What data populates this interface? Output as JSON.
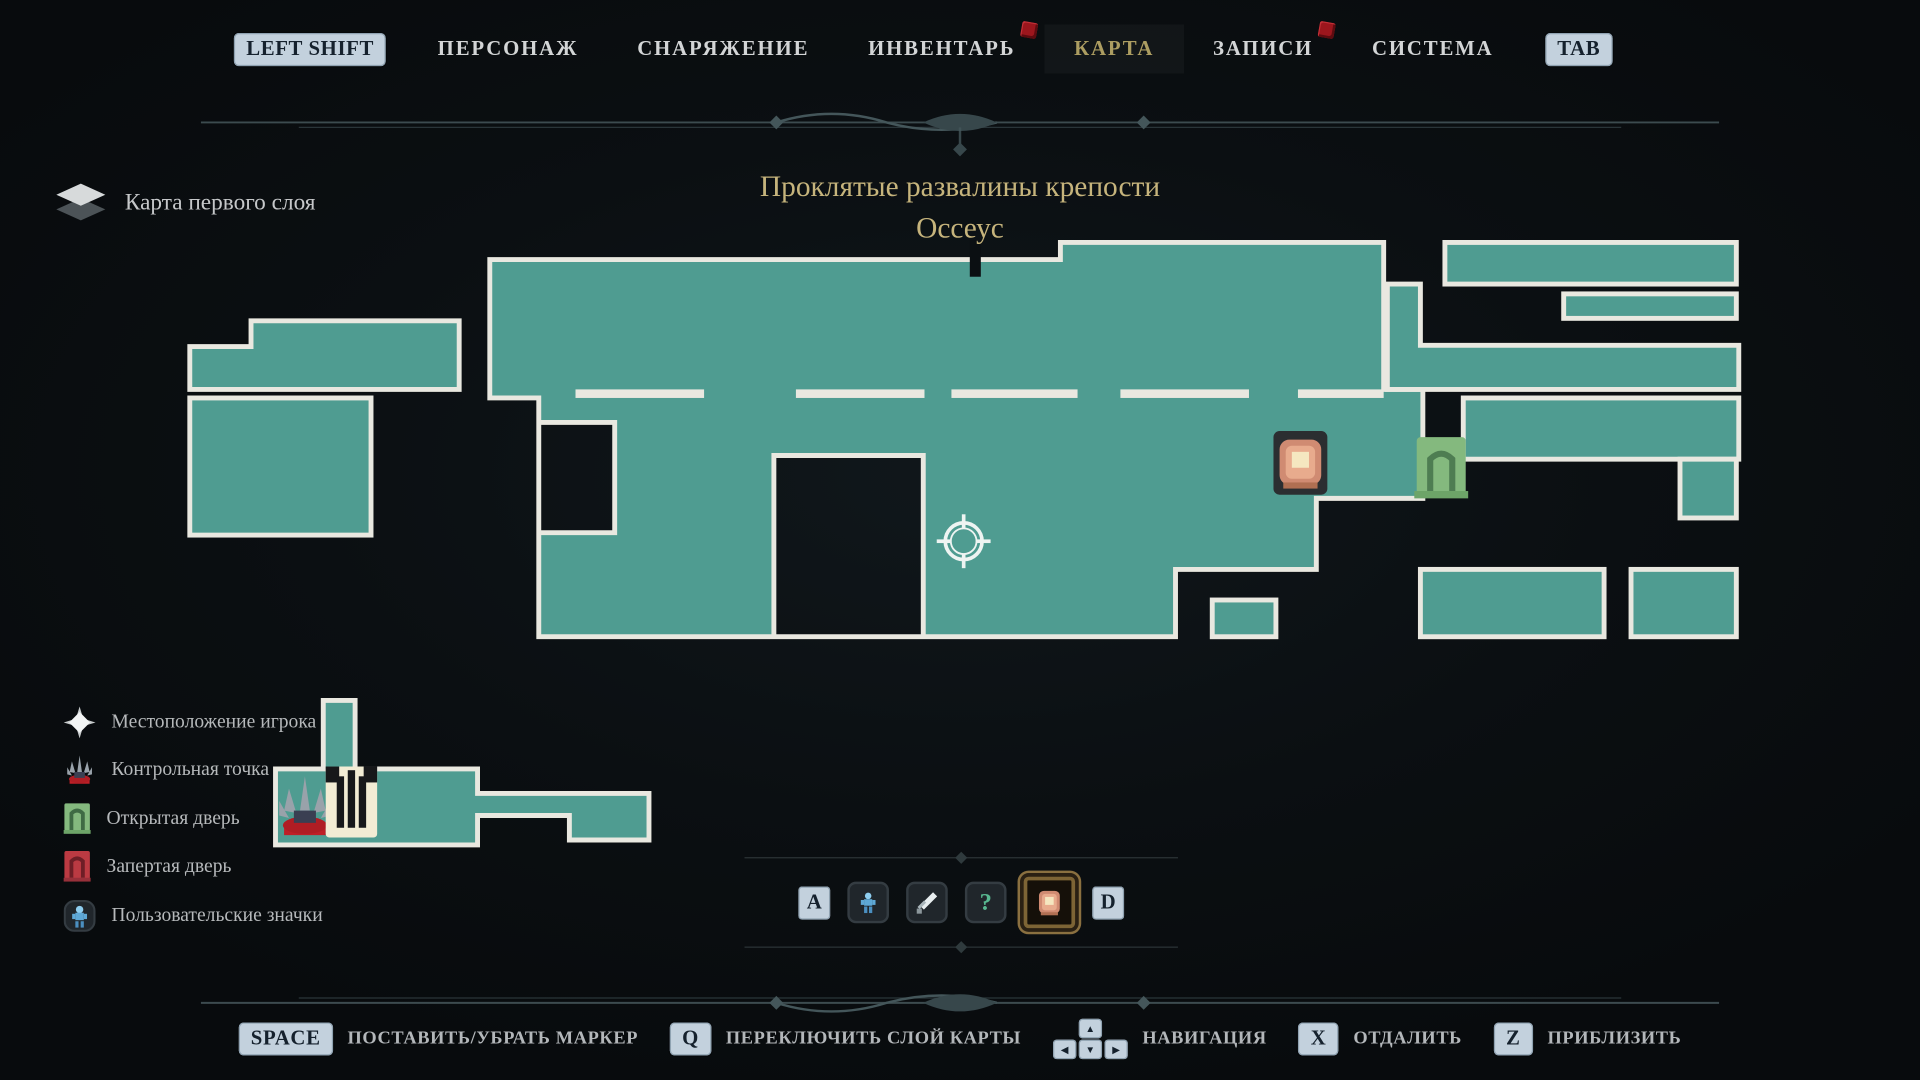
{
  "nav": {
    "left_key": "LEFT SHIFT",
    "right_key": "TAB",
    "tabs": [
      {
        "label": "ПЕРСОНАЖ"
      },
      {
        "label": "СНАРЯЖЕНИЕ"
      },
      {
        "label": "ИНВЕНТАРЬ",
        "badge": "new"
      },
      {
        "label": "КАРТА",
        "active": true
      },
      {
        "label": "ЗАПИСИ",
        "badge": "new"
      },
      {
        "label": "СИСТЕМА"
      }
    ]
  },
  "map_header": {
    "layer_label": "Карта первого слоя",
    "title_line1": "Проклятые развалины крепости",
    "title_line2": "Оссеус"
  },
  "legend": {
    "items": [
      {
        "icon": "player-location-icon",
        "label": "Местоположение игрока"
      },
      {
        "icon": "checkpoint-icon",
        "label": "Контрольная точка"
      },
      {
        "icon": "open-door-icon",
        "label": "Открытая дверь"
      },
      {
        "icon": "locked-door-icon",
        "label": "Запертая дверь"
      },
      {
        "icon": "custom-marker-icon",
        "label": "Пользовательские значки"
      }
    ]
  },
  "marker_selector": {
    "prev_key": "A",
    "next_key": "D",
    "markers": [
      {
        "name": "figure-marker",
        "selected": false
      },
      {
        "name": "sword-marker",
        "selected": false
      },
      {
        "name": "question-marker",
        "selected": false
      },
      {
        "name": "chest-marker",
        "selected": true
      }
    ],
    "question_glyph": "?"
  },
  "footer": {
    "hints": [
      {
        "key": "SPACE",
        "label": "ПОСТАВИТЬ/УБРАТЬ МАРКЕР"
      },
      {
        "key": "Q",
        "label": "ПЕРЕКЛЮЧИТЬ СЛОЙ КАРТЫ"
      },
      {
        "key": "ARROWS",
        "label": "НАВИГАЦИЯ"
      },
      {
        "key": "X",
        "label": "ОТДАЛИТЬ"
      },
      {
        "key": "Z",
        "label": "ПРИБЛИЗИТЬ"
      }
    ],
    "arrow_up": "▲",
    "arrow_left": "◀",
    "arrow_down": "▼",
    "arrow_right": "▶"
  },
  "colors": {
    "map_fill": "#4f9c91",
    "map_border": "#e9e8e0",
    "accent_gold": "#ac9d61",
    "badge_red": "#9c161d",
    "key_bg": "#c3d1dd"
  }
}
